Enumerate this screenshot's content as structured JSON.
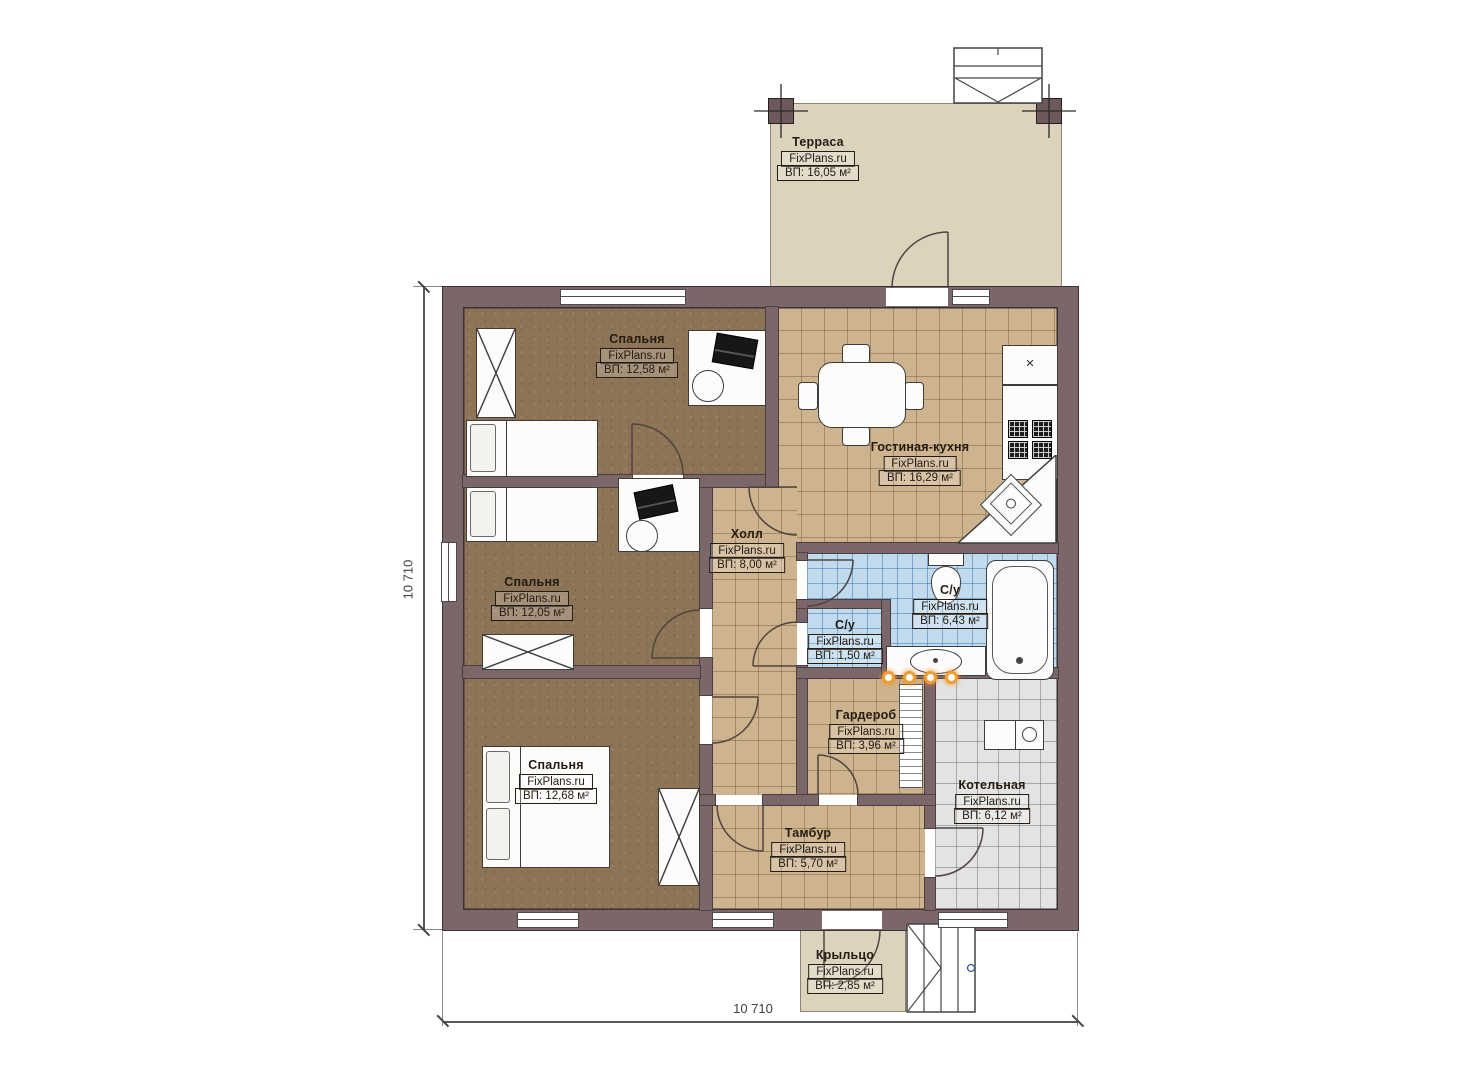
{
  "plan": {
    "brand": "FixPlans.ru",
    "dimensions": {
      "left": "10 710",
      "bottom": "10 710"
    },
    "rooms": [
      {
        "name": "Терраса",
        "brand": "FixPlans.ru",
        "area": "ВП: 16,05 м²"
      },
      {
        "name": "Спальня",
        "brand": "FixPlans.ru",
        "area": "ВП: 12,58 м²"
      },
      {
        "name": "Гостиная-кухня",
        "brand": "FixPlans.ru",
        "area": "ВП: 16,29 м²"
      },
      {
        "name": "Холл",
        "brand": "FixPlans.ru",
        "area": "ВП: 8,00 м²"
      },
      {
        "name": "Спальня",
        "brand": "FixPlans.ru",
        "area": "ВП: 12,05 м²"
      },
      {
        "name": "С/у",
        "brand": "FixPlans.ru",
        "area": "ВП: 6,43 м²"
      },
      {
        "name": "С/у",
        "brand": "FixPlans.ru",
        "area": "ВП: 1,50 м²"
      },
      {
        "name": "Гардероб",
        "brand": "FixPlans.ru",
        "area": "ВП: 3,96 м²"
      },
      {
        "name": "Спальня",
        "brand": "FixPlans.ru",
        "area": "ВП: 12,68 м²"
      },
      {
        "name": "Котельная",
        "brand": "FixPlans.ru",
        "area": "ВП: 6,12 м²"
      },
      {
        "name": "Тамбур",
        "brand": "FixPlans.ru",
        "area": "ВП: 5,70 м²"
      },
      {
        "name": "Крыльцо",
        "brand": "FixPlans.ru",
        "area": "ВП: 2,85 м²"
      }
    ],
    "colors": {
      "wall": "#7b666a",
      "bedroom_floor": "#8d7456",
      "tile_floor": "#cdb38e",
      "bath_tile": "#c0daee",
      "boiler_tile": "#e3e3e3",
      "terrace": "#ddd2bc",
      "spot_dots": "#ef9d38"
    }
  }
}
